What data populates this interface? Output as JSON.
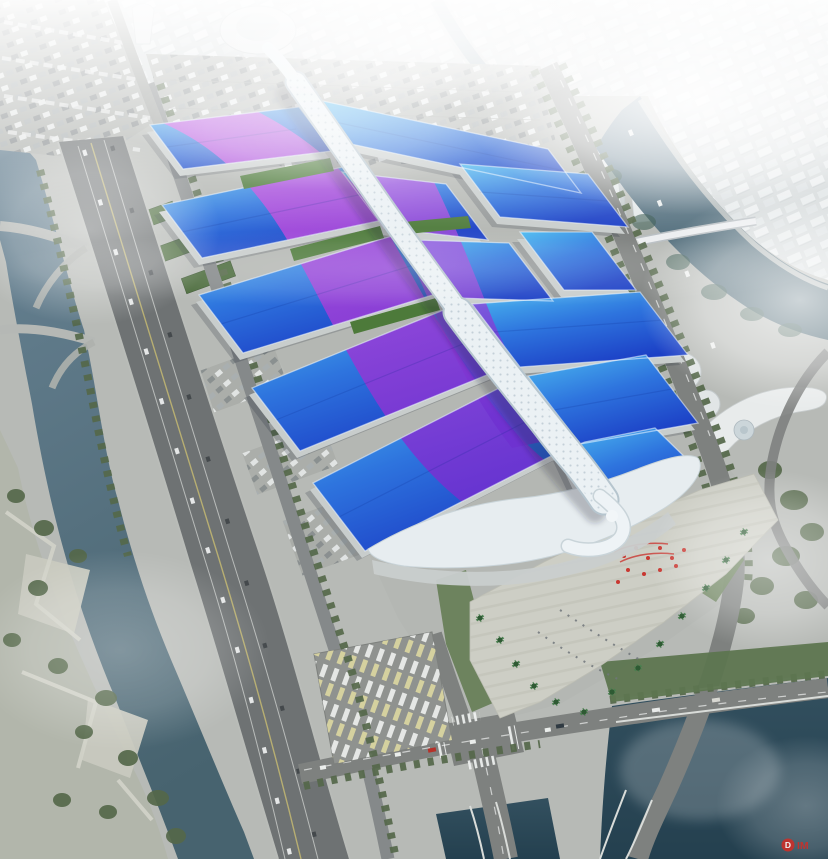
{
  "watermark": {
    "badge": "D",
    "text": "IM"
  },
  "colors": {
    "roof_light": "#4cbbf0",
    "roof_mid": "#2e74de",
    "roof_deep": "#1c40c6",
    "stripe_pink": "#cf4fe0",
    "stripe_violet": "#6e2fd0",
    "ribbon": "#ebf1f4",
    "ribbon_edge": "#b6c5ce",
    "green_roof": "#4d7a3a",
    "ground": "#b7bab6",
    "site": "#b4b7b3",
    "plaza": "#cdcec5",
    "road": "#7e817f",
    "highway": "#6e7273",
    "river": "#6a8495",
    "river_deep": "#47636f",
    "pond": "#33505f",
    "pond_deep": "#24404f",
    "tree": "#55684a",
    "city": "#d6dbdc",
    "fog": "#ffffff",
    "red": "#c9302a"
  }
}
